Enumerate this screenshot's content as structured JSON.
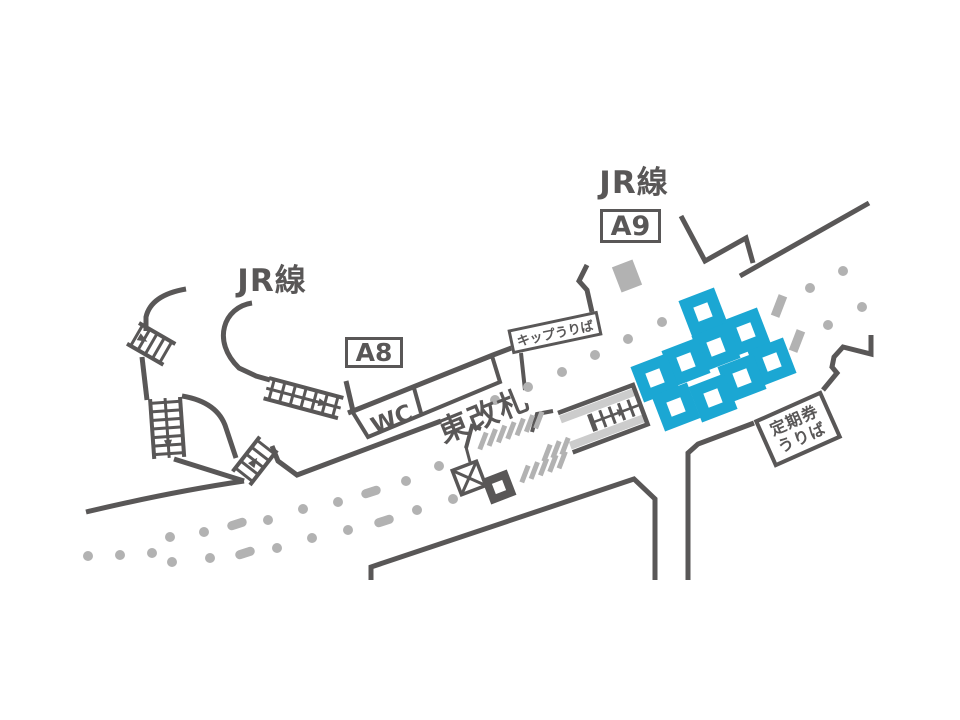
{
  "title": "station-concourse-map",
  "colors": {
    "wall": "#595757",
    "gray": "#b2b2b2",
    "stripe": "#cccccc",
    "machine_blue": "#1ba7d3",
    "bg": "#ffffff"
  },
  "labels": {
    "jr_left": "JR線",
    "jr_top": "JR線",
    "exit_a8": "A8",
    "exit_a9": "A9",
    "wc": "WC",
    "east_gate": "東改札",
    "ticket_window": "キップうりば",
    "pass_window_line1": "定期券",
    "pass_window_line2": "うりば"
  },
  "ticket_machines": {
    "size": 38,
    "hole": 15,
    "angle": -21,
    "positions": [
      [
        703,
        312
      ],
      [
        746,
        332
      ],
      [
        716,
        347
      ],
      [
        686,
        362
      ],
      [
        655,
        378
      ],
      [
        772,
        362
      ],
      [
        742,
        378
      ],
      [
        713,
        398
      ],
      [
        676,
        407
      ]
    ]
  },
  "tactile_dots": {
    "radius": 5,
    "positions": [
      [
        495,
        400
      ],
      [
        528,
        387
      ],
      [
        562,
        372
      ],
      [
        595,
        355
      ],
      [
        628,
        339
      ],
      [
        662,
        322
      ],
      [
        810,
        288
      ],
      [
        843,
        271
      ],
      [
        828,
        325
      ],
      [
        862,
        307
      ],
      [
        170,
        537
      ],
      [
        204,
        532
      ],
      [
        268,
        520
      ],
      [
        303,
        509
      ],
      [
        338,
        502
      ],
      [
        406,
        481
      ],
      [
        439,
        466
      ],
      [
        88,
        556
      ],
      [
        120,
        555
      ],
      [
        152,
        553
      ],
      [
        172,
        562
      ],
      [
        210,
        558
      ],
      [
        277,
        548
      ],
      [
        312,
        538
      ],
      [
        348,
        530
      ],
      [
        417,
        510
      ],
      [
        453,
        499
      ]
    ]
  },
  "tactile_dashes": {
    "w": 20,
    "h": 9,
    "angle": -18,
    "positions": [
      [
        237,
        524
      ],
      [
        245,
        553
      ],
      [
        371,
        492
      ],
      [
        384,
        521
      ]
    ]
  },
  "pillars": {
    "small_w": 9,
    "small_h": 22,
    "small_angle": 21,
    "small": [
      [
        779,
        306
      ],
      [
        797,
        341
      ]
    ],
    "large": [
      627,
      276
    ],
    "large_w": 22,
    "large_h": 27,
    "large_angle": -21
  },
  "gate_bars": {
    "w": 5,
    "h": 18,
    "angle": 21,
    "rows": [
      {
        "start": [
          483,
          441
        ],
        "step": [
          9.3,
          -3.5
        ],
        "count": 7
      },
      {
        "start": [
          525,
          474
        ],
        "step": [
          9.3,
          -3.5
        ],
        "count": 5
      },
      {
        "start": [
          547,
          453
        ],
        "step": [
          9.0,
          -3.4
        ],
        "count": 3
      }
    ]
  },
  "stairs": [
    {
      "name": "stair-northwest-upper",
      "x": 139,
      "y": 323,
      "angle": 30,
      "len": 42,
      "w": 24,
      "rungs": 5,
      "mid": false,
      "arrow": 0.3
    },
    {
      "name": "stair-northwest-lower",
      "x": 180,
      "y": 397,
      "angle": 86,
      "len": 60,
      "w": 30,
      "rungs": 7,
      "mid": true,
      "arrow": 0.8
    },
    {
      "name": "stair-a8",
      "x": 269,
      "y": 378,
      "angle": 15,
      "len": 77,
      "w": 21,
      "rungs": 7,
      "mid": true,
      "arrow": 0.78
    },
    {
      "name": "stair-center",
      "x": 250,
      "y": 485,
      "angle": -52,
      "len": 44,
      "w": -22,
      "rungs": 5,
      "mid": false,
      "arrow": 0.5
    }
  ]
}
